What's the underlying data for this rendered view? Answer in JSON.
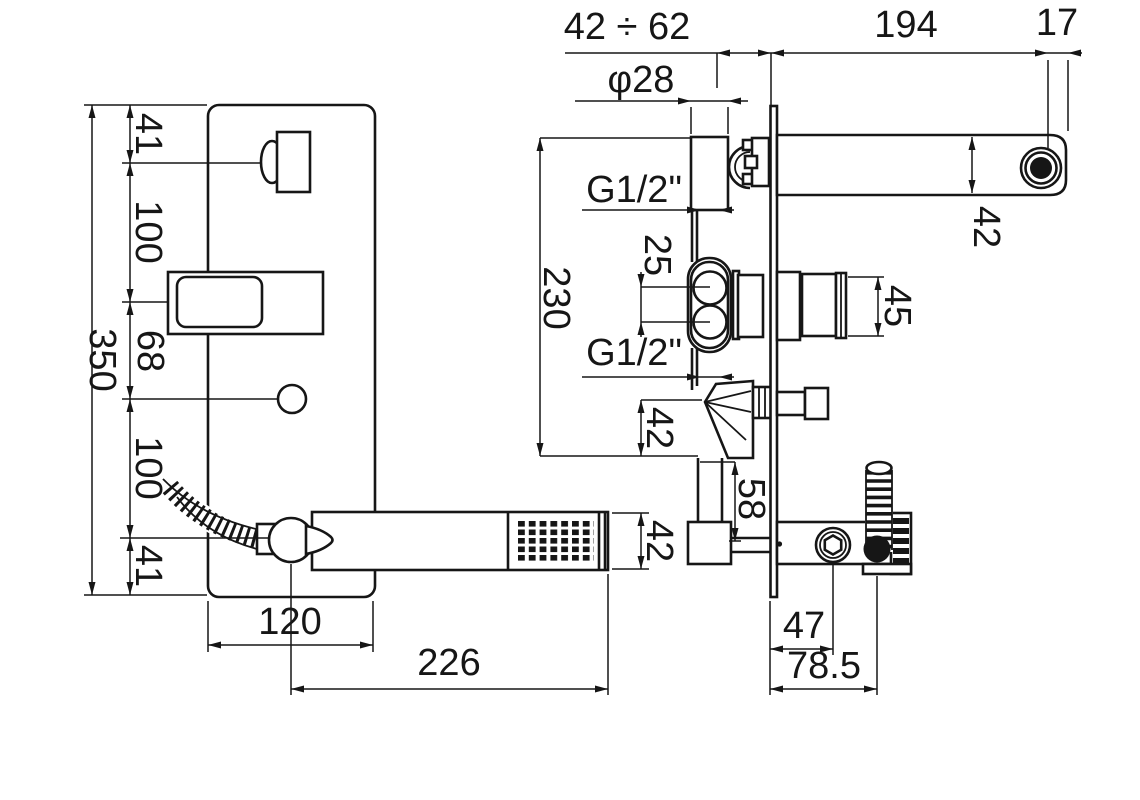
{
  "drawing": {
    "kind": "bath-mixer installation technical drawing",
    "views": {
      "front": "wall plate with spout, lever plate, diverter knob and hand shower",
      "side": "in-wall body with spout, cartridge handle, diverter and shower outlet"
    }
  },
  "dims": {
    "depth_range": "42 ÷ 62",
    "spout_dia": "φ28",
    "spout_proj": "194",
    "spout_end": "17",
    "spout_h": "42",
    "thread_top": "G1/2\"",
    "thread_bottom": "G1/2\"",
    "body_h": "230",
    "port_gap": "25",
    "div_drop": "42",
    "out_drop": "58",
    "handle_d": "45",
    "plate_h": "350",
    "seg1": "41",
    "seg2": "100",
    "seg3": "68",
    "seg4": "100",
    "seg5": "41",
    "plate_w": "120",
    "wand_len": "226",
    "wand_h": "42",
    "screw_off": "47",
    "hose_off": "78.5"
  }
}
